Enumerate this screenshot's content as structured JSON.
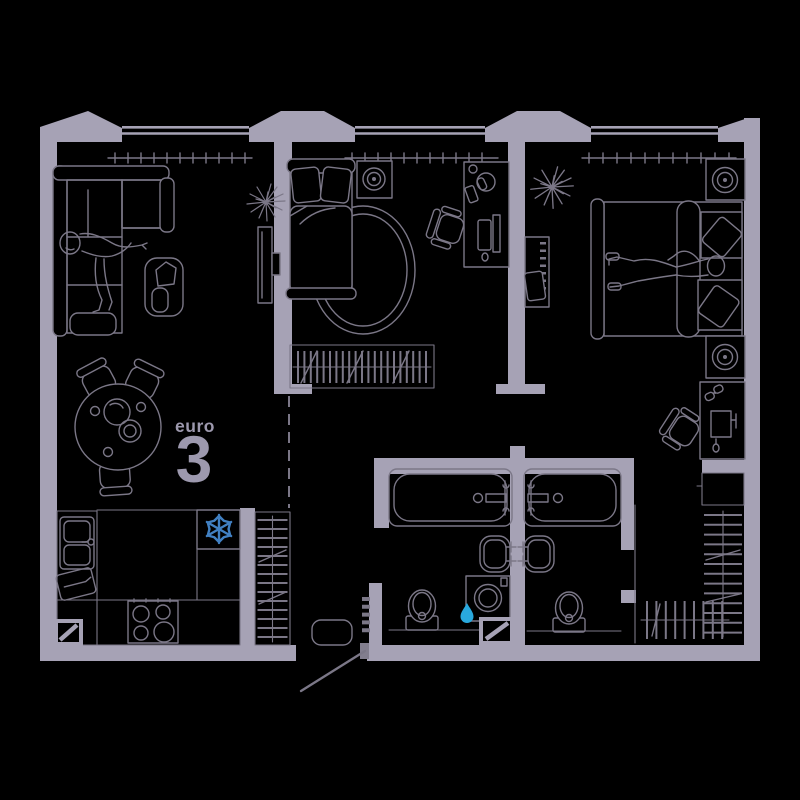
{
  "plan": {
    "label": {
      "prefix": "euro",
      "number": "3"
    }
  },
  "colors": {
    "background": "#000000",
    "wall": "#a6a2b5",
    "line": "#7b7787",
    "label": "#9d99ae",
    "snowflake": "#4180c2",
    "drop": "#29a9de"
  },
  "icons": [
    {
      "name": "snowflake-icon",
      "meaning": "refrigerator",
      "color": "#4180c2"
    },
    {
      "name": "water-drop-icon",
      "meaning": "washing machine / water point",
      "color": "#29a9de"
    }
  ],
  "rooms": [
    {
      "name": "living-room",
      "fixtures": [
        "corner-sofa",
        "person-lying",
        "side-table",
        "tv",
        "plant",
        "radiator",
        "window"
      ]
    },
    {
      "name": "kitchen-dining",
      "fixtures": [
        "dining-table",
        "chairs",
        "kitchen-counter",
        "sink",
        "cutting-board",
        "stove",
        "fridge-with-snowflake",
        "shaft"
      ]
    },
    {
      "name": "bedroom-1",
      "fixtures": [
        "single-bed",
        "oval-rug",
        "nightstand",
        "desk",
        "office-chair",
        "wardrobe",
        "radiator",
        "window"
      ]
    },
    {
      "name": "bedroom-2",
      "fixtures": [
        "double-bed",
        "person-lying",
        "two-nightstand-lamps",
        "tv-cabinet",
        "plant",
        "desk",
        "office-chair",
        "walk-in-closet",
        "radiator",
        "window"
      ]
    },
    {
      "name": "bathroom-1",
      "fixtures": [
        "bathtub",
        "washbasin",
        "washing-machine",
        "water-drop",
        "toilet",
        "shaft"
      ]
    },
    {
      "name": "bathroom-2",
      "fixtures": [
        "bathtub",
        "washbasin",
        "toilet"
      ]
    },
    {
      "name": "hallway",
      "fixtures": [
        "wardrobe",
        "coat-hooks",
        "doormat",
        "entrance-door"
      ]
    }
  ]
}
